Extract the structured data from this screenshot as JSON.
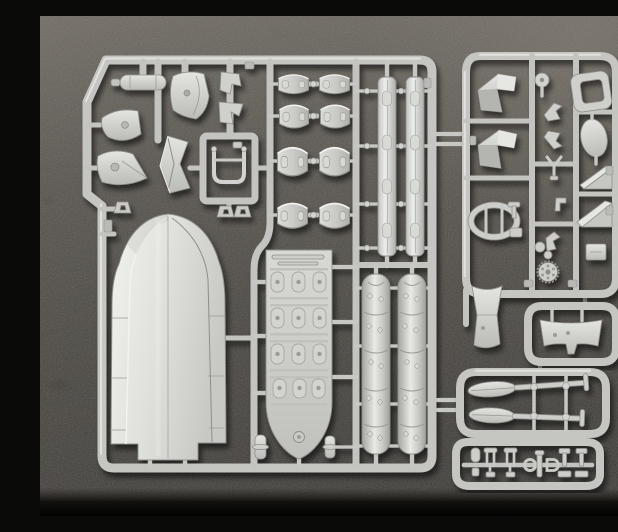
{
  "scene": {
    "type": "photograph",
    "description": "Overhead photo of light-gray injection-molded model kit sprues (runners full of unpainted parts) lying on a dark pebbled leather surface",
    "subject": "plastic scale-model kit sprue set for an inflatable assault boat with paddles",
    "surface": "black textured leather mat, brighter toward the top-right corner",
    "lighting": "soft daylight from the upper left casting small shadows under the sprues",
    "text_visible": "none"
  },
  "colors": {
    "plastic_base": "#c6c7c3",
    "plastic_highlight": "#ebece8",
    "plastic_shadow": "#8f908c",
    "background_top": "#4f4a43",
    "background_mid": "#262420",
    "background_dark": "#0d0c0a",
    "background_bottom": "#050505",
    "cast_shadow": "rgba(0,0,0,0.55)"
  },
  "sprues": {
    "main": {
      "name": "Main sprue with boat hull and large parts",
      "position": "left side, fills most of the photo",
      "parts": [
        "equipment cylinder",
        "bell-shaped mount",
        "cone-shaped mount",
        "three shackle eyelets",
        "curved cowl panel",
        "two angle brackets",
        "folded chevron panel",
        "U-shaped grab frame",
        "eight curved hull-segment panels in 4 rows x 2 columns",
        "two gunwale strips with oval recesses",
        "two riveted pontoon shell halves",
        "one-piece boat hull shell",
        "boat floor panel with 12 tread pads",
        "two bollard pegs"
      ]
    },
    "detail": {
      "name": "Detail sprue with small fittings",
      "position": "upper right",
      "parts": [
        "two angular mount brackets",
        "pulley disc",
        "rounded hatch ring",
        "solid oval blade",
        "two hook brackets",
        "Y-fork",
        "two wedge chocks",
        "oval cowl loop with crossbars",
        "toothed hub wheel",
        "junction box",
        "vertical transom panel",
        "assorted tiny fittings"
      ]
    },
    "transom_frame": {
      "name": "Transom mini-frame",
      "position": "right middle",
      "parts": [
        "stern transom panel with center tab"
      ]
    },
    "paddle_frame": {
      "name": "Paddle mini-frame",
      "position": "lower right",
      "parts": [
        "two paddles with T-grip handles",
        "two cross posts with collars"
      ]
    },
    "fittings_frame": {
      "name": "Small-fittings mini-frame",
      "position": "bottom right",
      "parts": [
        "mooring peg",
        "two wishbone rowlocks",
        "round ring",
        "stanchion post",
        "D-shackle",
        "two T-bollards"
      ]
    }
  }
}
